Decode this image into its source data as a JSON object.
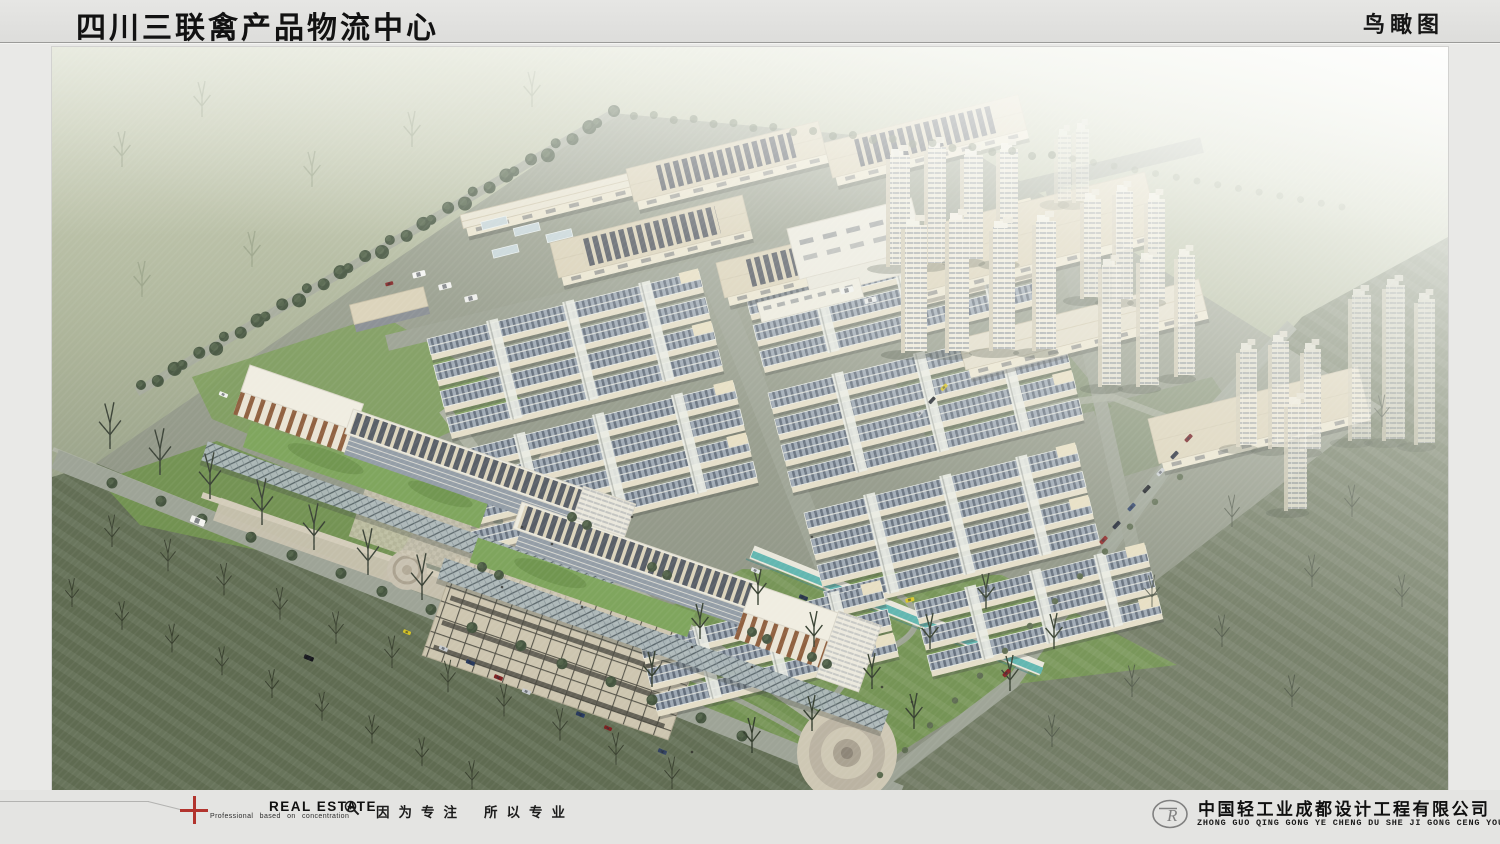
{
  "header": {
    "title": "四川三联禽产品物流中心",
    "view_label": "鸟瞰图"
  },
  "footer": {
    "brand": "REAL ESTATE",
    "brand_sub": "Professional based on concentration",
    "slogan_left": "因为专注",
    "slogan_right": "所以专业",
    "company_cn": "中国轻工业成都设计工程有限公司",
    "company_pinyin": "ZHONG GUO QING GONG YE CHENG DU SHE JI GONG CENG YOU XIAN GONG SI",
    "logo_monogram": "R"
  },
  "colors": {
    "frame": "#e9e9e7",
    "header_bg": "#e2e2e0",
    "accent_red": "#b2342e",
    "field_green_dark": "#5f6b51",
    "field_green_right": "#6b755d",
    "lawn_green": "#6e8e4d",
    "site_ground": "#8b9181",
    "road_gray": "#9ba194",
    "roof_blue_gray": "#8d98a6",
    "roof_beige": "#d9d0b6",
    "facade_brown": "#8a5836",
    "water_teal": "#58b2ac",
    "tower_cream": "#ece7d6",
    "fog_white": "#ffffff"
  }
}
